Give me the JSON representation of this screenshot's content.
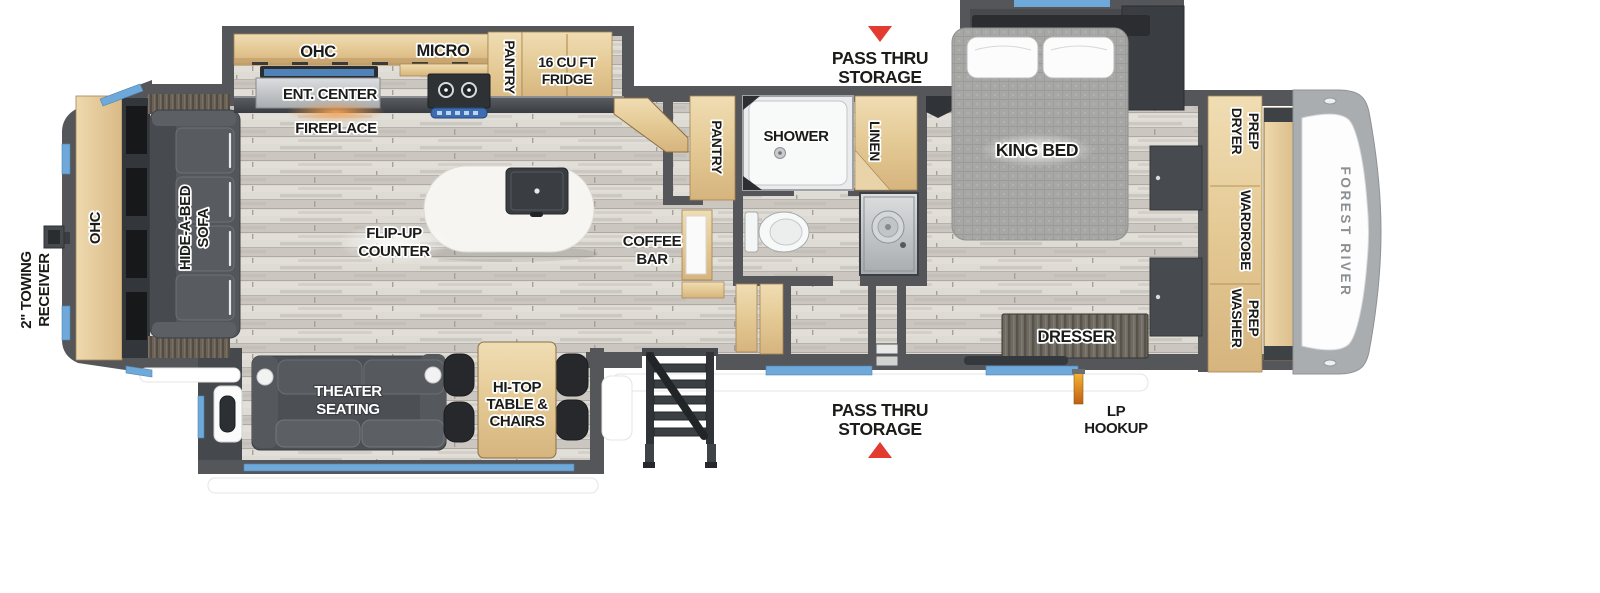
{
  "floorplan": {
    "brand": "FOREST RIVER",
    "colors": {
      "wall_gray": "#54565a",
      "window_blue": "#6fa9d9",
      "arrow_red": "#e23b31",
      "lp_orange": "#e8891f",
      "cabinet_wood": "#e6cfa4"
    },
    "exterior": {
      "towing": [
        "2\" TOWING",
        "RECEIVER"
      ],
      "pass_thru_top": [
        "PASS THRU",
        "STORAGE"
      ],
      "pass_thru_bottom": [
        "PASS THRU",
        "STORAGE"
      ],
      "lp": [
        "LP",
        "HOOKUP"
      ]
    },
    "living": {
      "rear_ohc": "OHC",
      "sofa": [
        "HIDE-A-BED",
        "SOFA"
      ],
      "fireplace": "FIREPLACE",
      "ent_center": "ENT. CENTER",
      "theater": [
        "THEATER",
        "SEATING"
      ],
      "hitop": [
        "HI-TOP",
        "TABLE &",
        "CHAIRS"
      ],
      "island": [
        "FLIP-UP",
        "COUNTER"
      ]
    },
    "kitchen": {
      "ohc": "OHC",
      "micro": "MICRO",
      "pantry": "PANTRY",
      "fridge": [
        "16 CU FT",
        "FRIDGE"
      ],
      "coffee": [
        "COFFEE",
        "BAR"
      ]
    },
    "hall": {
      "pantry": "PANTRY"
    },
    "bath": {
      "shower": "SHOWER",
      "linen": "LINEN"
    },
    "bedroom": {
      "bed": "KING BED",
      "dresser": "DRESSER",
      "dryer": [
        "DRYER",
        "PREP"
      ],
      "wardrobe": "WARDROBE",
      "washer": [
        "WASHER",
        "PREP"
      ]
    }
  }
}
